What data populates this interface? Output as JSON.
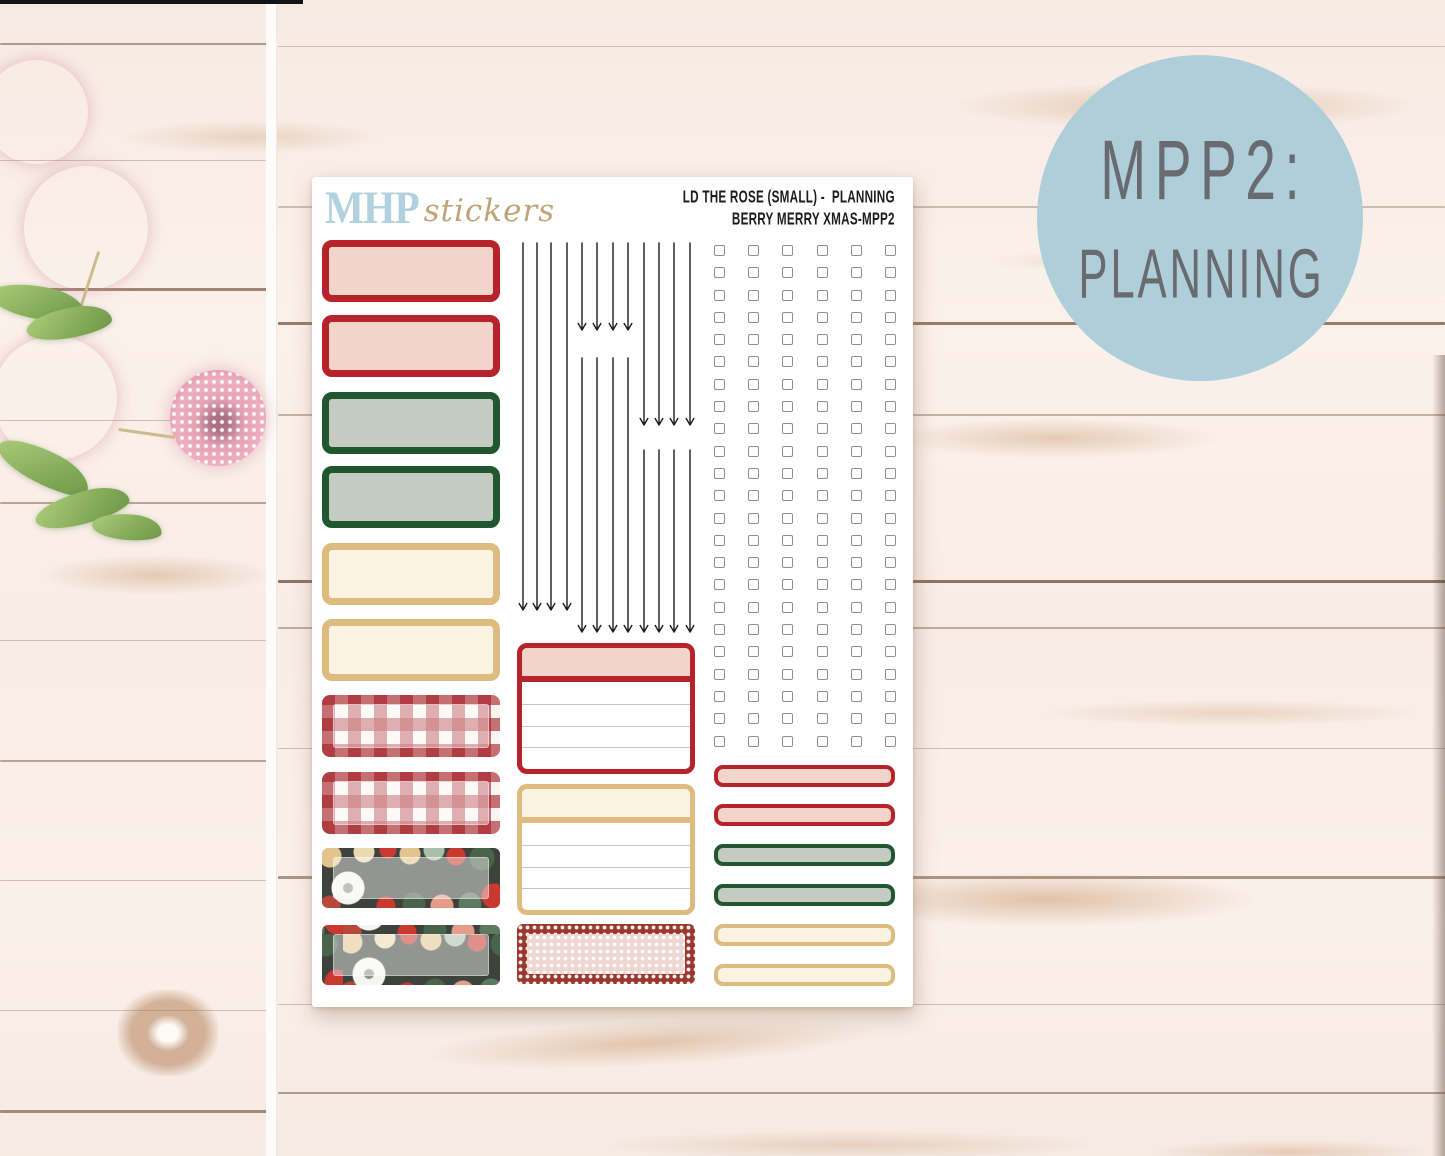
{
  "badge": {
    "line1": "MPP2:",
    "line2": "PLANNING",
    "bg_color": "#aecfd9",
    "text_color": "#6a6a71"
  },
  "sheet": {
    "logo": {
      "brand": "MHP",
      "suffix": "stickers",
      "brand_color": "#b2d1de",
      "suffix_color": "#bfa478"
    },
    "header": {
      "line1": "LD THE ROSE (SMALL) -  PLANNING",
      "line2": "BERRY MERRY XMAS-MPP2",
      "color": "#1c1c1c"
    },
    "quarter_boxes": [
      "red",
      "red",
      "green",
      "green",
      "tan",
      "tan",
      "gingham",
      "gingham",
      "floral",
      "floral"
    ],
    "arrow_columns": [
      {
        "x": 211,
        "segments": [
          [
            66,
            433
          ]
        ]
      },
      {
        "x": 225,
        "segments": [
          [
            66,
            433
          ]
        ]
      },
      {
        "x": 239,
        "segments": [
          [
            66,
            433
          ]
        ]
      },
      {
        "x": 255,
        "segments": [
          [
            66,
            433
          ]
        ]
      },
      {
        "x": 270,
        "segments": [
          [
            66,
            153
          ],
          [
            181,
            455
          ]
        ]
      },
      {
        "x": 285,
        "segments": [
          [
            66,
            153
          ],
          [
            181,
            455
          ]
        ]
      },
      {
        "x": 301,
        "segments": [
          [
            66,
            153
          ],
          [
            181,
            455
          ]
        ]
      },
      {
        "x": 316,
        "segments": [
          [
            66,
            153
          ],
          [
            181,
            455
          ]
        ]
      },
      {
        "x": 332,
        "segments": [
          [
            66,
            248
          ],
          [
            273,
            455
          ]
        ]
      },
      {
        "x": 347,
        "segments": [
          [
            66,
            248
          ],
          [
            273,
            455
          ]
        ]
      },
      {
        "x": 362,
        "segments": [
          [
            66,
            248
          ],
          [
            273,
            455
          ]
        ]
      },
      {
        "x": 378,
        "segments": [
          [
            66,
            248
          ],
          [
            273,
            455
          ]
        ]
      }
    ],
    "lined_boxes": [
      {
        "style": "red",
        "lines": 3
      },
      {
        "style": "tan",
        "lines": 3
      }
    ],
    "dotted_box": {
      "style": "red-dot"
    },
    "checkbox_grid": {
      "rows": 23,
      "cols": 6
    },
    "quarter_bars": [
      "red",
      "red",
      "green",
      "green",
      "tan",
      "tan"
    ]
  },
  "colors": {
    "red_border": "#b6232a",
    "red_fill": "#f2d4cb",
    "green_border": "#20572f",
    "green_fill": "#c4ccc1",
    "tan_border": "#debc80",
    "tan_fill": "#faf3e2",
    "floral_bg": "#3e423d",
    "dot_border_bg": "#9c372e",
    "dot_fill_bg": "#eed7d1",
    "checkbox_border": "#8f8f8f",
    "arrow_color": "#1c1c1c"
  }
}
